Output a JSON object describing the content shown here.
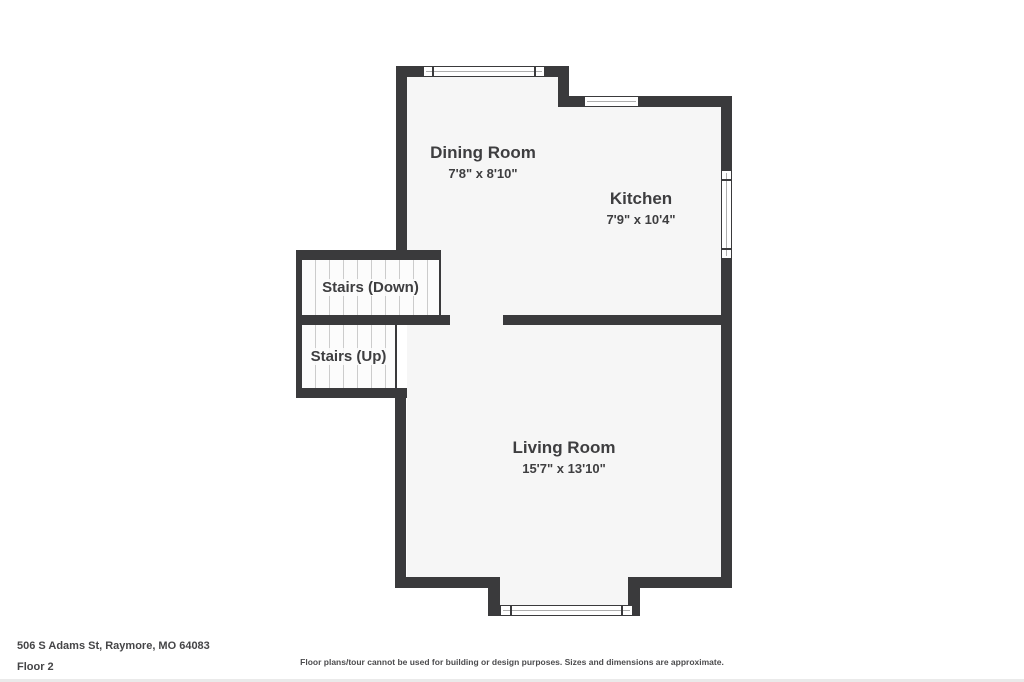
{
  "floorplan": {
    "rooms": [
      {
        "name": "Dining Room",
        "dimensions": "7'8\" x 8'10\""
      },
      {
        "name": "Kitchen",
        "dimensions": "7'9\" x 10'4\""
      },
      {
        "name": "Living Room",
        "dimensions": "15'7\" x 13'10\""
      }
    ],
    "stairs": [
      {
        "label": "Stairs (Down)"
      },
      {
        "label": "Stairs (Up)"
      }
    ]
  },
  "footer": {
    "address": "506 S Adams St, Raymore, MO 64083",
    "floor_label": "Floor 2",
    "disclaimer": "Floor plans/tour cannot be used for building or design purposes. Sizes and dimensions are approximate."
  },
  "colors": {
    "wall": "#3a3a3c",
    "floor": "#f6f6f6",
    "stair_floor": "#fcfcfc",
    "text": "#3e3e40"
  }
}
